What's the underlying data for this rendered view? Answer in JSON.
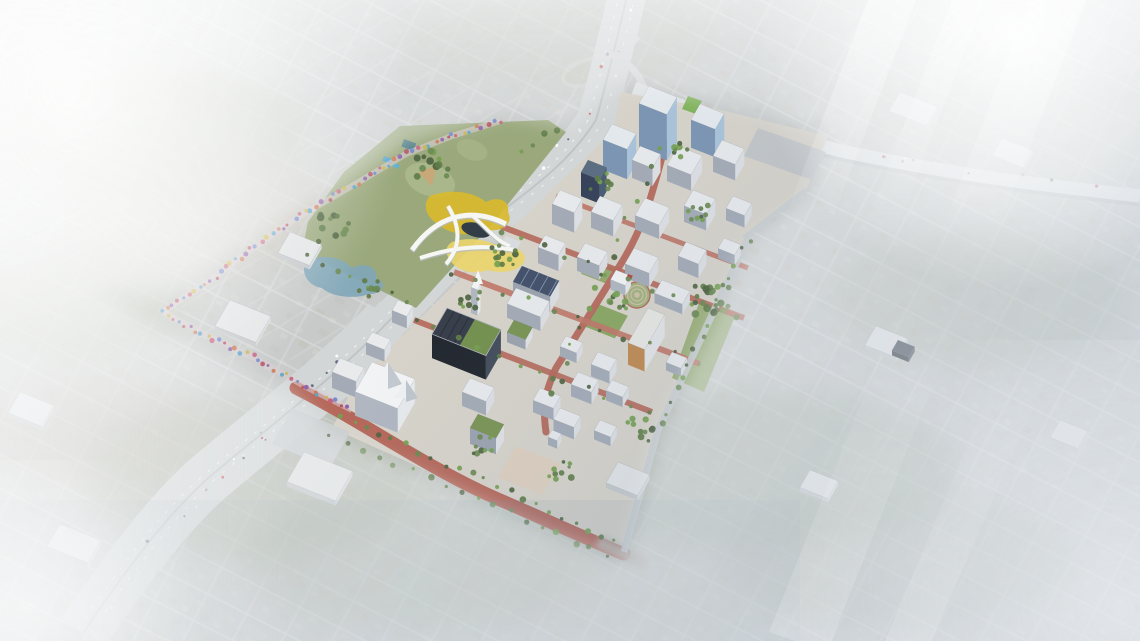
{
  "image": {
    "kind": "aerial-architectural-rendering",
    "subject": "oblique aerial rendering of a downtown innovation-district master plan: a sharp, saturated campus of white mid-rise buildings, red-brick streets, a green-roof arena, blue glass towers, a yellow sculptural land-bridge pavilion, and a multicolor art-street corridor, surrounded by a hazy, desaturated existing city grid",
    "width": 1140,
    "height": 641
  },
  "scene": {
    "palette": {
      "base_city": "#c7cac9",
      "city_street": "#dadcdc",
      "park_grass": "#9aa87c",
      "park_field": "#aab78a",
      "infield": "#c8a878",
      "water": "#7fa6b8",
      "pool": "#4fa3c7",
      "freeway": "#d3d6d7",
      "campus_ground": "#d7d3ca",
      "plaza": "#decfbe",
      "street_red": "#b5685a",
      "street_red_light": "#c8816e",
      "lawn": "#8aa763",
      "yellow": "#d9ba2e",
      "yellow_light": "#ecd56a",
      "ribbon_white": "#f6f6f3",
      "haze": "#eef1f3",
      "trees": [
        "#4e6440",
        "#5f7d48",
        "#74a050",
        "#6b8a52"
      ]
    },
    "types": {
      "white": {
        "roof": "#e8eaec",
        "se": "#dde0e4",
        "sw": "#a4abb6"
      },
      "bright": {
        "roof": "#f2f3f5",
        "se": "#e6e9ec",
        "sw": "#b0b7c1"
      },
      "glass": {
        "roof": "#e4e9ed",
        "se": "#a9c3da",
        "sw": "#7b95b2"
      },
      "navy": {
        "roof": "#5c6d82",
        "se": "#4a5c72",
        "sw": "#36425a"
      },
      "dark": {
        "roof": "#383f4b",
        "se": "#454d5c",
        "sw": "#23282f"
      },
      "solar": {
        "roof": "#44516a",
        "se": "#dcdfe2",
        "sw": "#9ba3ae"
      },
      "green": {
        "roof": "#7a9454",
        "se": "#dfe2e4",
        "sw": "#9ba3ae"
      },
      "warm": {
        "roof": "#e7e6e2",
        "se": "#e2e4e6",
        "sw": "#c08a52"
      },
      "faded": {
        "roof": "#e2e4e5",
        "se": "#d7dadb",
        "sw": "#c4c8cb"
      }
    },
    "buildings": [
      {
        "name": "blue-glass-tower",
        "type": "glass",
        "x": 649,
        "y": 86,
        "w": 30,
        "d": 20,
        "h": 46
      },
      {
        "name": "glass-office-block",
        "type": "glass",
        "x": 700,
        "y": 104,
        "w": 26,
        "d": 18,
        "h": 28
      },
      {
        "name": "glass-midrise",
        "type": "glass",
        "x": 612,
        "y": 124,
        "w": 26,
        "d": 18,
        "h": 30
      },
      {
        "name": "navy-glass-tower",
        "type": "navy",
        "x": 588,
        "y": 160,
        "w": 20,
        "d": 14,
        "h": 24
      },
      {
        "type": "white",
        "x": 640,
        "y": 146,
        "w": 22,
        "d": 16,
        "h": 18
      },
      {
        "type": "white",
        "x": 678,
        "y": 146,
        "w": 26,
        "d": 22,
        "h": 16
      },
      {
        "type": "white",
        "x": 722,
        "y": 140,
        "w": 24,
        "d": 18,
        "h": 16
      },
      {
        "type": "white",
        "x": 560,
        "y": 190,
        "w": 24,
        "d": 16,
        "h": 20
      },
      {
        "type": "white",
        "x": 600,
        "y": 196,
        "w": 24,
        "d": 18,
        "h": 16
      },
      {
        "type": "white",
        "x": 645,
        "y": 198,
        "w": 26,
        "d": 20,
        "h": 14
      },
      {
        "type": "white",
        "x": 693,
        "y": 190,
        "w": 24,
        "d": 18,
        "h": 16
      },
      {
        "type": "white",
        "x": 733,
        "y": 196,
        "w": 20,
        "d": 14,
        "h": 12
      },
      {
        "type": "white",
        "x": 545,
        "y": 235,
        "w": 22,
        "d": 14,
        "h": 16
      },
      {
        "type": "white",
        "x": 585,
        "y": 243,
        "w": 24,
        "d": 16,
        "h": 14
      },
      {
        "type": "white",
        "x": 634,
        "y": 248,
        "w": 26,
        "d": 18,
        "h": 14
      },
      {
        "type": "white",
        "x": 686,
        "y": 242,
        "w": 22,
        "d": 16,
        "h": 14
      },
      {
        "type": "white",
        "x": 724,
        "y": 238,
        "w": 18,
        "d": 12,
        "h": 10
      },
      {
        "name": "solar-roof-hall",
        "type": "solar",
        "x": 522,
        "y": 266,
        "w": 40,
        "d": 18,
        "h": 16
      },
      {
        "name": "lab-building",
        "type": "white",
        "x": 516,
        "y": 288,
        "w": 36,
        "d": 18,
        "h": 14
      },
      {
        "type": "green",
        "x": 514,
        "y": 320,
        "w": 20,
        "d": 14,
        "h": 10
      },
      {
        "name": "plaza-pavilion",
        "type": "bright",
        "x": 616,
        "y": 270,
        "w": 16,
        "d": 11,
        "h": 10
      },
      {
        "name": "folded-roof-pavilion",
        "type": "white",
        "x": 662,
        "y": 280,
        "w": 30,
        "d": 15,
        "h": 10
      },
      {
        "name": "apartment-orange-accent",
        "type": "warm",
        "x": 648,
        "y": 308,
        "w": 18,
        "d": 40,
        "h": 22
      },
      {
        "type": "white",
        "x": 672,
        "y": 352,
        "w": 16,
        "d": 12,
        "h": 8
      },
      {
        "name": "arena-green-roof",
        "type": "dark",
        "x": 447,
        "y": 308,
        "w": 58,
        "d": 30,
        "h": 24
      },
      {
        "type": "white",
        "x": 566,
        "y": 336,
        "w": 18,
        "d": 12,
        "h": 10
      },
      {
        "type": "white",
        "x": 598,
        "y": 352,
        "w": 20,
        "d": 14,
        "h": 12
      },
      {
        "name": "museum",
        "type": "bright",
        "x": 372,
        "y": 362,
        "w": 46,
        "d": 34,
        "h": 24
      },
      {
        "name": "bell-tower",
        "type": "bright",
        "x": 474,
        "y": 282,
        "w": 7,
        "d": 6,
        "h": 26
      },
      {
        "type": "white",
        "x": 470,
        "y": 378,
        "w": 26,
        "d": 16,
        "h": 14
      },
      {
        "name": "green-roof-hall",
        "type": "green",
        "x": 478,
        "y": 414,
        "w": 28,
        "d": 16,
        "h": 16
      },
      {
        "type": "white",
        "x": 540,
        "y": 388,
        "w": 22,
        "d": 14,
        "h": 12
      },
      {
        "type": "white",
        "x": 578,
        "y": 372,
        "w": 22,
        "d": 14,
        "h": 12
      },
      {
        "type": "white",
        "x": 612,
        "y": 380,
        "w": 18,
        "d": 12,
        "h": 10
      },
      {
        "type": "white",
        "x": 560,
        "y": 408,
        "w": 22,
        "d": 13,
        "h": 12
      },
      {
        "type": "white",
        "x": 600,
        "y": 420,
        "w": 18,
        "d": 12,
        "h": 9
      },
      {
        "type": "white",
        "x": 552,
        "y": 430,
        "w": 10,
        "d": 8,
        "h": 8
      },
      {
        "type": "white",
        "x": 398,
        "y": 300,
        "w": 16,
        "d": 12,
        "h": 12
      },
      {
        "type": "white",
        "x": 372,
        "y": 332,
        "w": 20,
        "d": 12,
        "h": 12
      },
      {
        "type": "white",
        "x": 340,
        "y": 358,
        "w": 26,
        "d": 16,
        "h": 16
      },
      {
        "type": "faded",
        "x": 290,
        "y": 232,
        "w": 34,
        "d": 24,
        "h": 4
      },
      {
        "type": "faded",
        "x": 230,
        "y": 300,
        "w": 44,
        "d": 30,
        "h": 4
      },
      {
        "type": "faded",
        "x": 304,
        "y": 452,
        "w": 52,
        "d": 34,
        "h": 5
      },
      {
        "type": "faded",
        "x": 60,
        "y": 524,
        "w": 44,
        "d": 26,
        "h": 5
      },
      {
        "type": "faded",
        "x": 20,
        "y": 392,
        "w": 36,
        "d": 24,
        "h": 4
      },
      {
        "type": "faded",
        "x": 900,
        "y": 92,
        "w": 40,
        "d": 22,
        "h": 3
      },
      {
        "type": "faded",
        "x": 1002,
        "y": 138,
        "w": 34,
        "d": 20,
        "h": 3
      },
      {
        "type": "faded",
        "x": 876,
        "y": 326,
        "w": 34,
        "d": 22,
        "h": 4
      },
      {
        "type": "dark",
        "x": 898,
        "y": 340,
        "w": 18,
        "d": 12,
        "h": 5
      },
      {
        "type": "faded",
        "x": 1060,
        "y": 420,
        "w": 30,
        "d": 20,
        "h": 3
      },
      {
        "type": "faded",
        "x": 810,
        "y": 470,
        "w": 30,
        "d": 20,
        "h": 4
      },
      {
        "type": "faded",
        "x": 618,
        "y": 462,
        "w": 34,
        "d": 24,
        "h": 5
      }
    ],
    "trees": {
      "rows": [
        {
          "x1": 340,
          "y1": 416,
          "x2": 615,
          "y2": 540,
          "n": 22
        },
        {
          "x1": 330,
          "y1": 436,
          "x2": 608,
          "y2": 556,
          "n": 18
        },
        {
          "x1": 660,
          "y1": 150,
          "x2": 548,
          "y2": 396,
          "n": 15
        },
        {
          "x1": 748,
          "y1": 238,
          "x2": 660,
          "y2": 426,
          "n": 16
        },
        {
          "x1": 500,
          "y1": 232,
          "x2": 738,
          "y2": 320,
          "n": 12
        },
        {
          "x1": 454,
          "y1": 274,
          "x2": 700,
          "y2": 364,
          "n": 11
        },
        {
          "x1": 414,
          "y1": 322,
          "x2": 650,
          "y2": 412,
          "n": 12
        },
        {
          "x1": 310,
          "y1": 258,
          "x2": 408,
          "y2": 302,
          "n": 8
        },
        {
          "x1": 520,
          "y1": 150,
          "x2": 560,
          "y2": 128,
          "n": 4
        }
      ],
      "clusters": [
        {
          "x": 505,
          "y": 255,
          "n": 12,
          "s": 26
        },
        {
          "x": 715,
          "y": 300,
          "n": 20,
          "s": 40
        },
        {
          "x": 700,
          "y": 215,
          "n": 9,
          "s": 24
        },
        {
          "x": 620,
          "y": 300,
          "n": 9,
          "s": 22
        },
        {
          "x": 560,
          "y": 470,
          "n": 10,
          "s": 26
        },
        {
          "x": 430,
          "y": 162,
          "n": 12,
          "s": 36
        },
        {
          "x": 332,
          "y": 228,
          "n": 12,
          "s": 34
        },
        {
          "x": 470,
          "y": 300,
          "n": 8,
          "s": 20
        },
        {
          "x": 640,
          "y": 430,
          "n": 10,
          "s": 28
        },
        {
          "x": 480,
          "y": 444,
          "n": 8,
          "s": 24
        },
        {
          "x": 600,
          "y": 180,
          "n": 8,
          "s": 26
        },
        {
          "x": 680,
          "y": 150,
          "n": 7,
          "s": 22
        },
        {
          "x": 368,
          "y": 290,
          "n": 8,
          "s": 22
        }
      ]
    },
    "corridor": {
      "colors": [
        "#c4607a",
        "#6f86c9",
        "#b44f62",
        "#8b5fa8",
        "#c97a54",
        "#5aa0c9",
        "#c9b44f"
      ],
      "segments": [
        [
          [
            500,
            121
          ],
          [
            452,
            136
          ],
          [
            406,
            154
          ],
          [
            352,
            186
          ],
          [
            300,
            216
          ],
          [
            262,
            242
          ],
          [
            216,
            276
          ],
          [
            163,
            312
          ]
        ],
        [
          [
            163,
            312
          ],
          [
            208,
            336
          ],
          [
            258,
            360
          ],
          [
            308,
            388
          ],
          [
            352,
            410
          ]
        ]
      ]
    },
    "freeway": {
      "points": [
        [
          628,
          0
        ],
        [
          596,
          120
        ],
        [
          488,
          222
        ],
        [
          388,
          322
        ],
        [
          206,
          480
        ],
        [
          100,
          614
        ]
      ],
      "east_branch": [
        [
          640,
          95
        ],
        [
          760,
          132
        ],
        [
          900,
          160
        ],
        [
          1140,
          194
        ]
      ],
      "car_colors": [
        "#ffffff",
        "#e8eaec",
        "#c94f4f",
        "#55627a",
        "#9aa2ad"
      ],
      "cars_main": 30,
      "cars_east": 14
    }
  }
}
